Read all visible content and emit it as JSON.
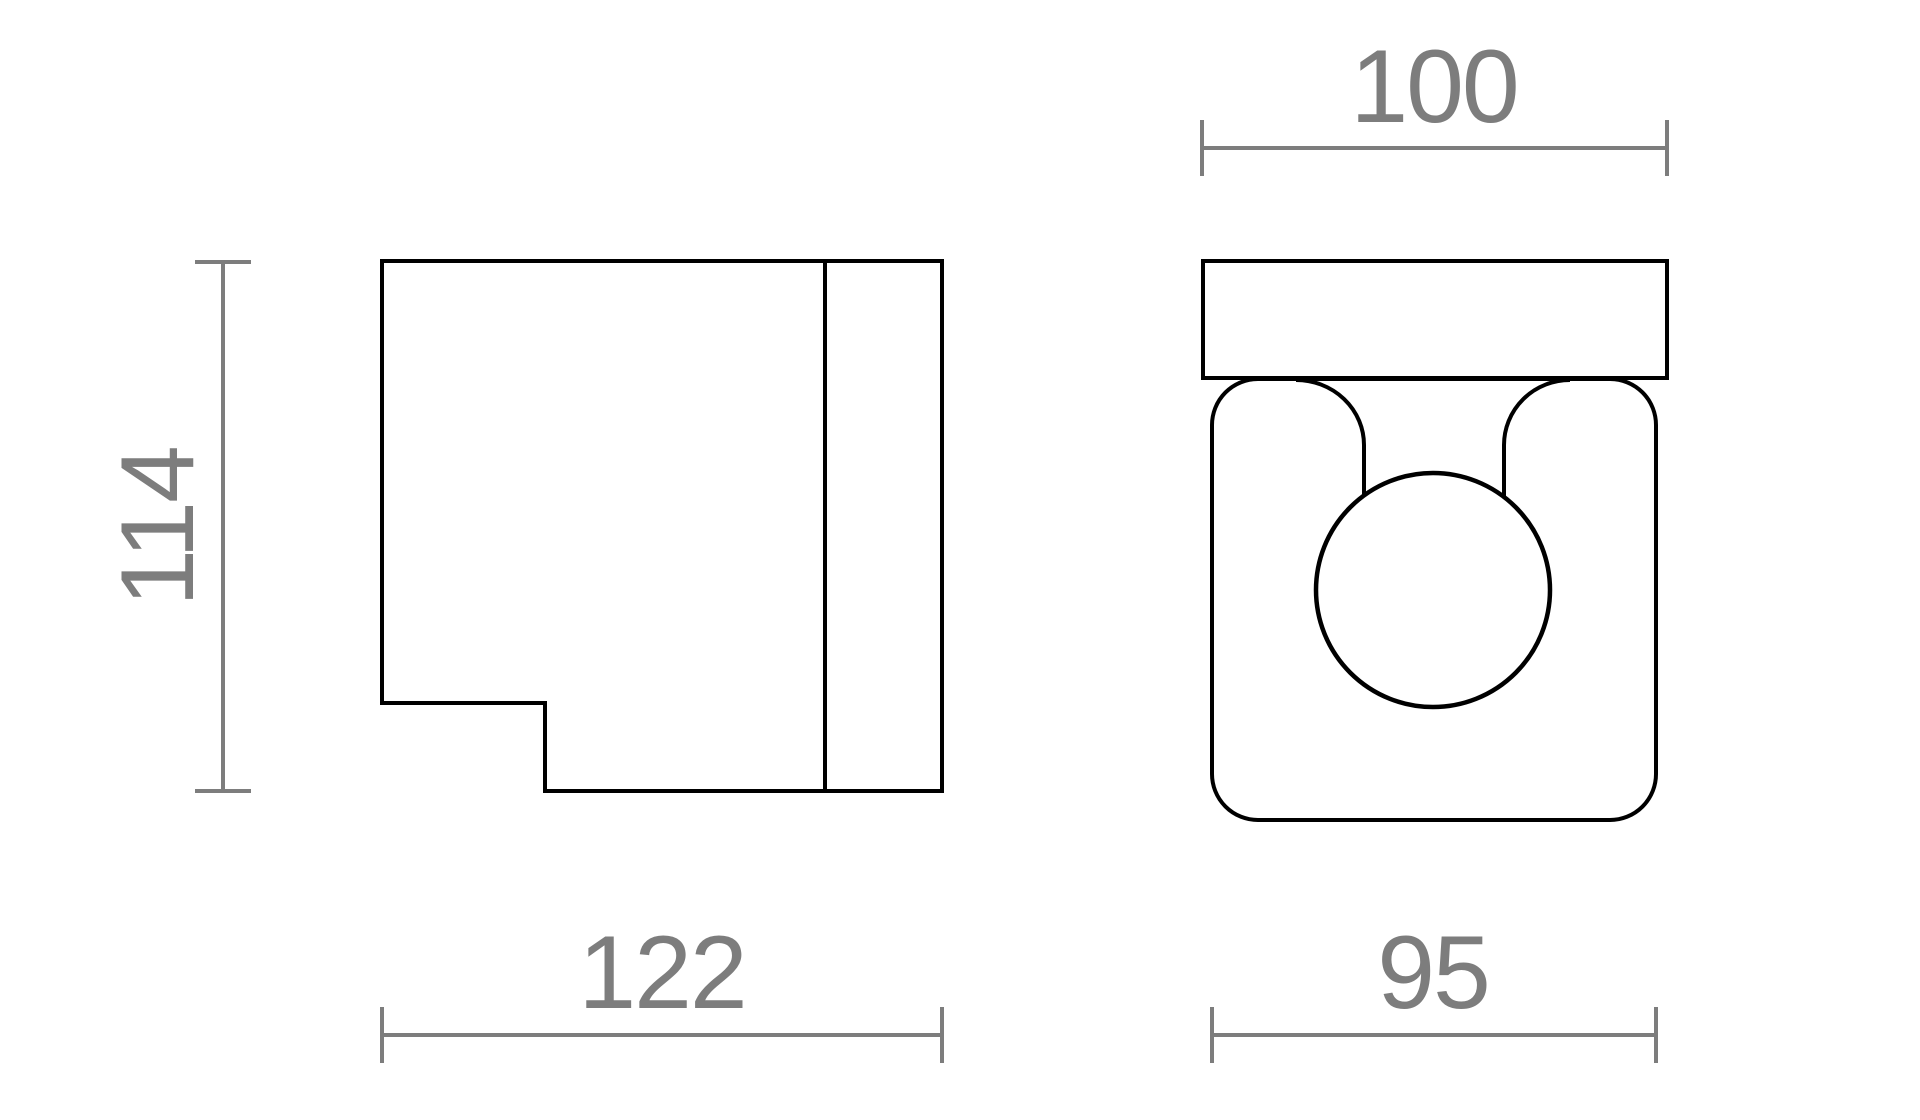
{
  "meta": {
    "background": "#ffffff",
    "canvas_width": 1920,
    "canvas_height": 1120,
    "description": "Technical dimension drawing of a wall lamp, two orthographic views"
  },
  "style": {
    "outline_color": "#000000",
    "outline_width": 4,
    "sphere_outline_width": 4.5,
    "dim_color": "#7d7d7d",
    "dim_line_width": 4,
    "dim_tick_width": 4,
    "dim_tick_length": 56,
    "dim_font_size": 104,
    "dim_letter_spacing": "-0.02em"
  },
  "side_view": {
    "name": "side-view",
    "outline_points": [
      [
        382,
        261
      ],
      [
        942,
        261
      ],
      [
        942,
        791
      ],
      [
        545,
        791
      ],
      [
        545,
        703
      ],
      [
        382,
        703
      ]
    ],
    "mount_divider": {
      "x": 825,
      "y1": 261,
      "y2": 791
    }
  },
  "front_view": {
    "name": "front-view",
    "mount_plate": {
      "x": 1203,
      "y": 261,
      "width": 464,
      "height": 117
    },
    "body": {
      "x": 1212,
      "y": 379,
      "width": 444,
      "height": 441,
      "corner_radius": 46
    },
    "sphere": {
      "cx": 1433,
      "cy": 590,
      "r": 117
    },
    "arms": {
      "left": {
        "path": "M 1296 380 A 68 65 0 0 1 1364 445 L 1364 496"
      },
      "right": {
        "path": "M 1570 380 A 66 65 0 0 0 1504 445 L 1504 496"
      }
    }
  },
  "dimensions": [
    {
      "id": "side-height",
      "label": "114",
      "orientation": "vertical",
      "axis": 223,
      "from": 262,
      "to": 791,
      "text_x": 193,
      "text_y": 527
    },
    {
      "id": "side-width",
      "label": "122",
      "orientation": "horizontal",
      "axis": 1035,
      "from": 382,
      "to": 942,
      "text_x": 662,
      "text_y": 1008
    },
    {
      "id": "front-plate-width",
      "label": "100",
      "orientation": "horizontal",
      "axis": 148,
      "from": 1202,
      "to": 1667,
      "text_x": 1434,
      "text_y": 122
    },
    {
      "id": "front-body-width",
      "label": "95",
      "orientation": "horizontal",
      "axis": 1035,
      "from": 1212,
      "to": 1656,
      "text_x": 1433,
      "text_y": 1008
    }
  ]
}
